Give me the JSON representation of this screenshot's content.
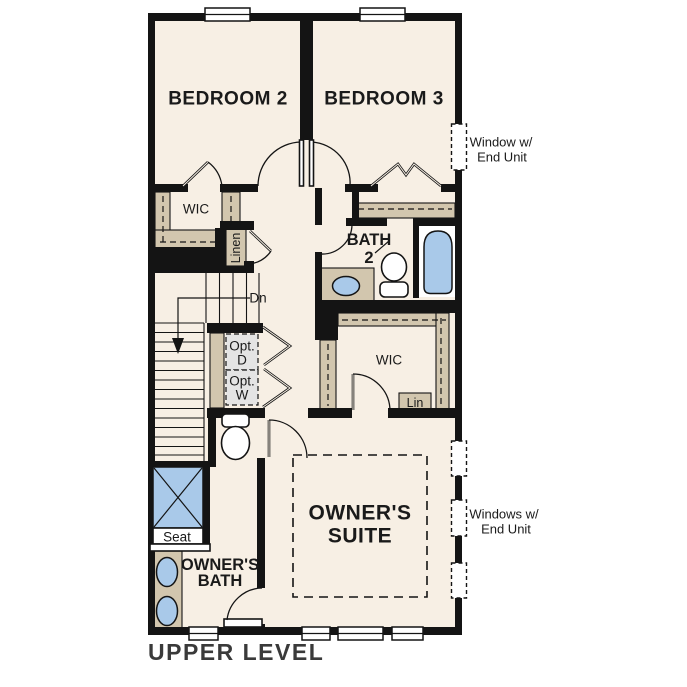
{
  "title": "UPPER LEVEL",
  "colors": {
    "background": "#ffffff",
    "floor": "#f7efe4",
    "wall": "#141414",
    "shelf_tan": "#d2c6ae",
    "fixture_blue": "#a9c9e9",
    "appliance_gray": "#e4e4e4",
    "label_text": "#1a1a1a",
    "title_text": "#3a3a3a"
  },
  "labels": {
    "bedroom2": "BEDROOM 2",
    "bedroom3": "BEDROOM 3",
    "bedroom2_closet": "WIC",
    "linen_closet": "Linen",
    "stairs_direction": "Dn",
    "bath2_line1": "BATH",
    "bath2_line2": "2",
    "opt_dryer_line1": "Opt.",
    "opt_dryer_line2": "D",
    "opt_washer_line1": "Opt.",
    "opt_washer_line2": "W",
    "owners_wic": "WIC",
    "owners_linen": "Lin",
    "owners_suite_line1": "OWNER'S",
    "owners_suite_line2": "SUITE",
    "shower_seat": "Seat",
    "owners_bath_line1": "OWNER'S",
    "owners_bath_line2": "BATH"
  },
  "annotations": {
    "right_top_line1": "Window w/",
    "right_top_line2": "End Unit",
    "right_bottom_line1": "Windows w/",
    "right_bottom_line2": "End Unit"
  }
}
